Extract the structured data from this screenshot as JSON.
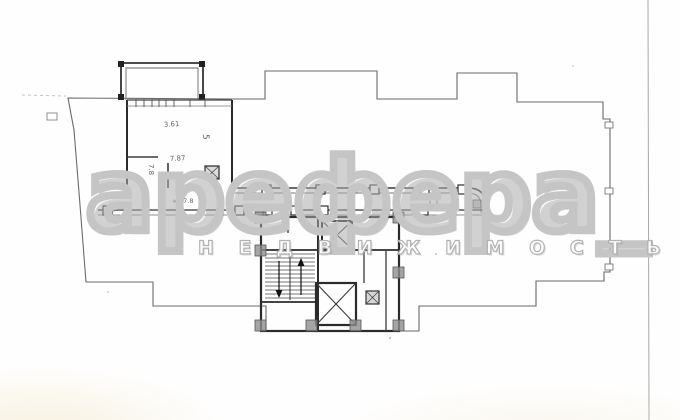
{
  "watermark": {
    "logo_text": "арефера_",
    "subtitle": "Н Е Д В И Ж И М О С Т Ь"
  },
  "plan_labels": {
    "dim_361": "3.61",
    "room_5": "5",
    "dim_78": "7.8",
    "dim_787": "7.87",
    "corridor_label": "кл.7.8"
  },
  "colors": {
    "paper": "#ffffff",
    "thin_line": "#6a6a6a",
    "wall_dark": "#2b2b2b",
    "watermark_gray": "#c5c5c5",
    "subtitle_outline": "#b2b2b2"
  }
}
